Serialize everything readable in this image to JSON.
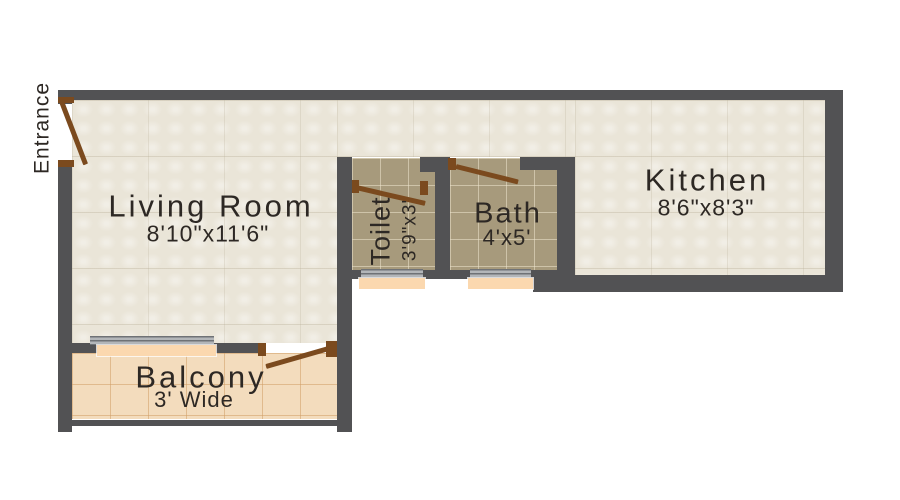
{
  "plan": {
    "entrance_label": "Entrance",
    "rooms": [
      {
        "name": "Living Room",
        "size": "8'10\"x11'6\""
      },
      {
        "name": "Toilet",
        "size": "3'9\"x3'"
      },
      {
        "name": "Bath",
        "size": "4'x5'"
      },
      {
        "name": "Kitchen",
        "size": "8'6\"x8'3\""
      },
      {
        "name": "Balcony",
        "size": "3' Wide"
      }
    ],
    "colors": {
      "wall": "#525254",
      "floor_main": "#eae5d8",
      "floor_wet": "#a79a7c",
      "floor_balcony": "#f3dcbd",
      "window_sill": "#fbd8af",
      "door": "#7b4a1e",
      "text": "#2d2824"
    }
  }
}
